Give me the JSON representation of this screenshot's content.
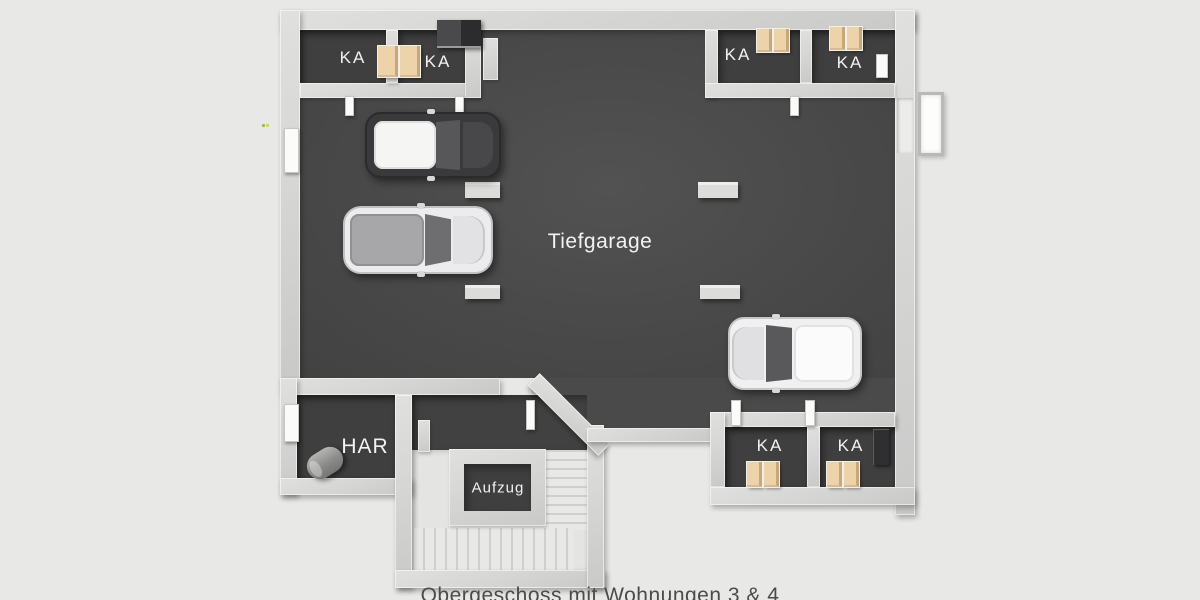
{
  "scene": {
    "title": "Tiefgarage",
    "caption": "Obergeschoss mit Wohnungen 3 & 4",
    "rooms": [
      {
        "id": "ka-top-left-1",
        "label": "KA"
      },
      {
        "id": "ka-top-left-2",
        "label": "KA"
      },
      {
        "id": "ka-top-right-1",
        "label": "KA"
      },
      {
        "id": "ka-top-right-2",
        "label": "KA"
      },
      {
        "id": "har",
        "label": "HAR"
      },
      {
        "id": "aufzug",
        "label": "Aufzug"
      },
      {
        "id": "ka-bottom-1",
        "label": "KA"
      },
      {
        "id": "ka-bottom-2",
        "label": "KA"
      }
    ],
    "cars": [
      {
        "id": "car-dark-white-roof"
      },
      {
        "id": "car-silver-suv"
      },
      {
        "id": "car-white"
      }
    ],
    "colors": {
      "background": "#e8e8e7",
      "wall": "#d6d6d5",
      "garage_floor": "#4a4a4a",
      "room_floor": "#3f3f3f",
      "crate": "#ecd3a9",
      "label_text": "#f2f2f2",
      "caption_text": "#4b4b4b"
    }
  }
}
